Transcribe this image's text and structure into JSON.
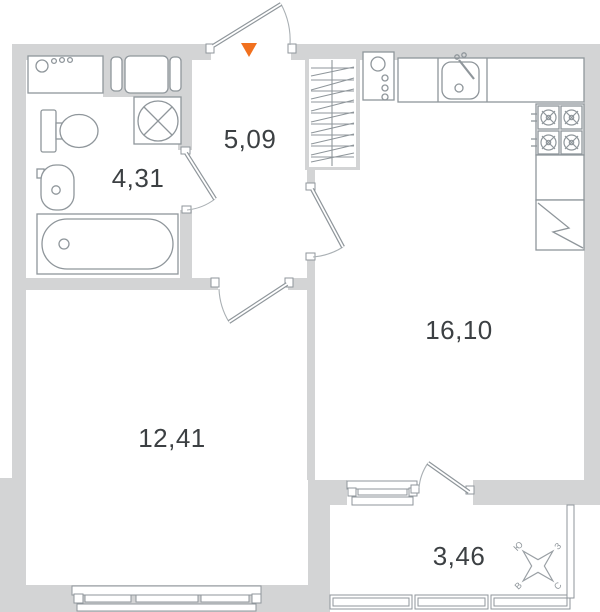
{
  "rooms": {
    "hallway": {
      "area": "5,09"
    },
    "bathroom": {
      "area": "4,31"
    },
    "living": {
      "area": "12,41"
    },
    "kitchen": {
      "area": "16,10"
    },
    "balcony": {
      "area": "3,46"
    }
  },
  "compass": {
    "north": "С",
    "east": "В",
    "south": "Ю",
    "west": "З"
  },
  "colors": {
    "wall": "#d3d4d5",
    "outline": "#8f969b",
    "text": "#3c4043",
    "entrance_marker": "#f1701e"
  }
}
